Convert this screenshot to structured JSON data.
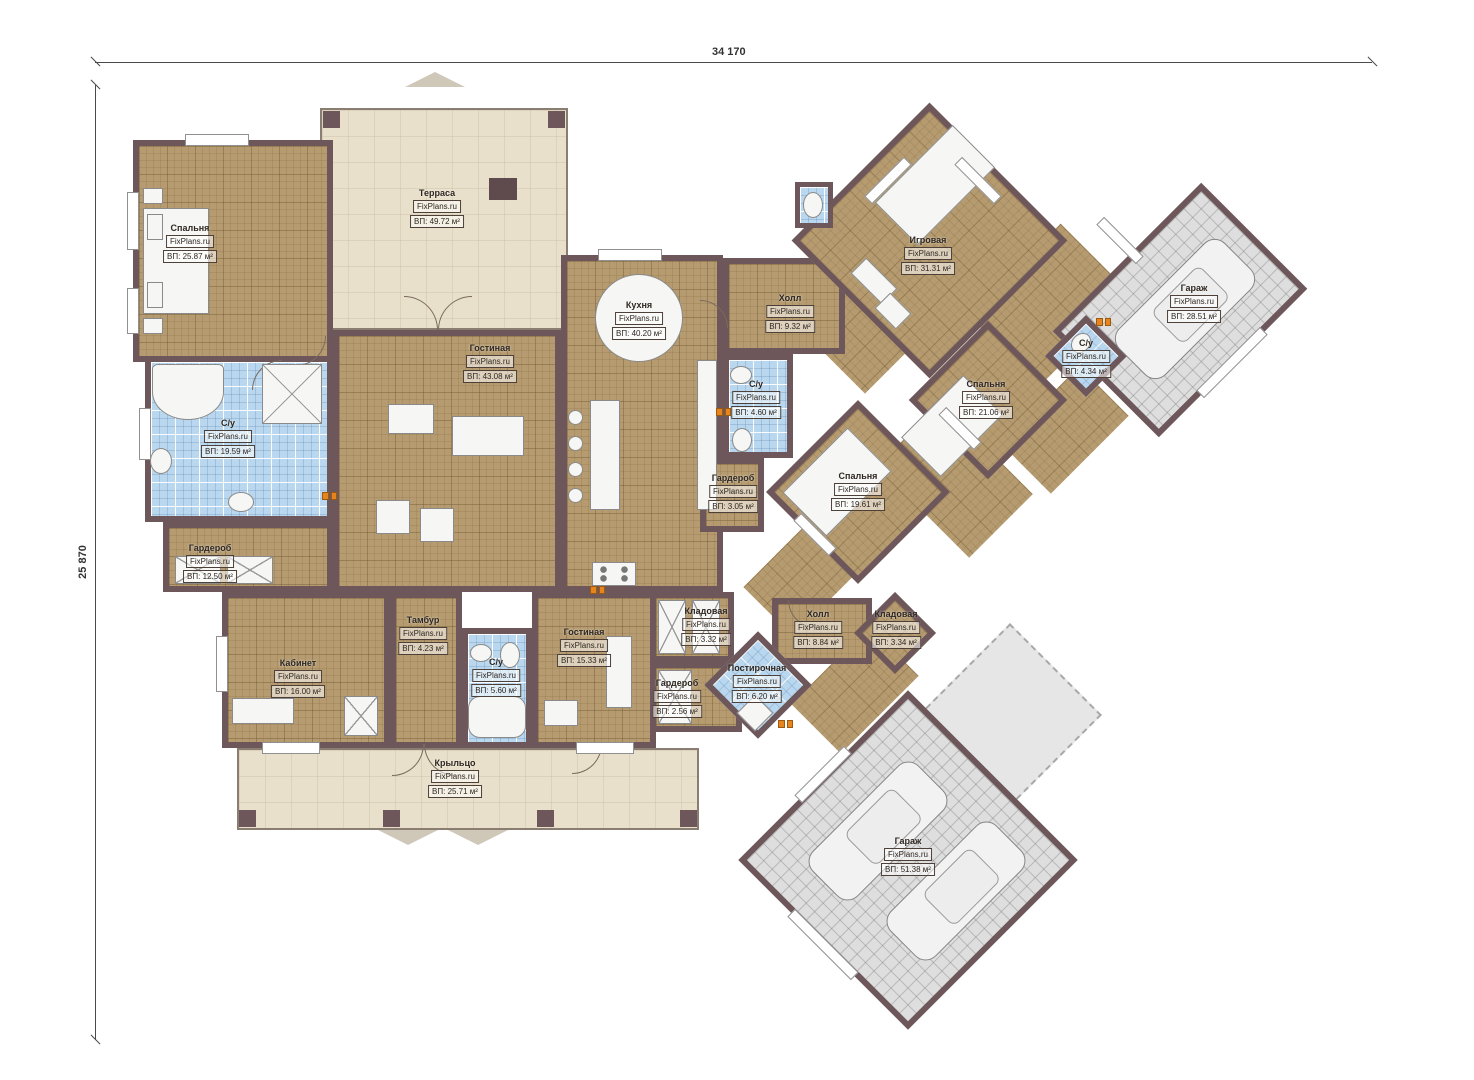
{
  "watermark": "FixPlans.ru",
  "dimensions": {
    "top": "34 170",
    "left": "25 870"
  },
  "rooms": [
    {
      "id": "bedroom-tl",
      "name": "Спальня",
      "area": "ВП: 25.87 м²"
    },
    {
      "id": "terrace",
      "name": "Терраса",
      "area": "ВП: 49.72 м²"
    },
    {
      "id": "living",
      "name": "Гостиная",
      "area": "ВП: 43.08 м²"
    },
    {
      "id": "kitchen",
      "name": "Кухня",
      "area": "ВП: 40.20 м²"
    },
    {
      "id": "hall-upper",
      "name": "Холл",
      "area": "ВП: 9.32 м²"
    },
    {
      "id": "game-room",
      "name": "Игровая",
      "area": "ВП: 31.31 м²"
    },
    {
      "id": "garage-top",
      "name": "Гараж",
      "area": "ВП: 28.51 м²"
    },
    {
      "id": "wc-right",
      "name": "С/у",
      "area": "ВП: 4.34 м²"
    },
    {
      "id": "bedroom-right",
      "name": "Спальня",
      "area": "ВП: 21.06 м²"
    },
    {
      "id": "bedroom-center",
      "name": "Спальня",
      "area": "ВП: 19.61 м²"
    },
    {
      "id": "wc-mid",
      "name": "С/у",
      "area": "ВП: 4.60 м²"
    },
    {
      "id": "wardrobe-mid",
      "name": "Гардероб",
      "area": "ВП: 3.05 м²"
    },
    {
      "id": "bath-left",
      "name": "С/у",
      "area": "ВП: 19.59 м²"
    },
    {
      "id": "wardrobe-left",
      "name": "Гардероб",
      "area": "ВП: 12.50 м²"
    },
    {
      "id": "office",
      "name": "Кабинет",
      "area": "ВП: 16.00 м²"
    },
    {
      "id": "tambour",
      "name": "Тамбур",
      "area": "ВП: 4.23 м²"
    },
    {
      "id": "wc-bottom",
      "name": "С/у",
      "area": "ВП: 5.60 м²"
    },
    {
      "id": "living-2",
      "name": "Гостиная",
      "area": "ВП: 15.33 м²"
    },
    {
      "id": "pantry-1",
      "name": "Кладовая",
      "area": "ВП: 3.32 м²"
    },
    {
      "id": "hall-lower",
      "name": "Холл",
      "area": "ВП: 8.84 м²"
    },
    {
      "id": "laundry",
      "name": "Постирочная",
      "area": "ВП: 6.20 м²"
    },
    {
      "id": "wardrobe-bottom",
      "name": "Гардероб",
      "area": "ВП: 2.56 м²"
    },
    {
      "id": "pantry-2",
      "name": "Кладовая",
      "area": "ВП: 3.34 м²"
    },
    {
      "id": "porch",
      "name": "Крыльцо",
      "area": "ВП: 25.71 м²"
    },
    {
      "id": "garage-bottom",
      "name": "Гараж",
      "area": "ВП: 51.38 м²"
    }
  ]
}
